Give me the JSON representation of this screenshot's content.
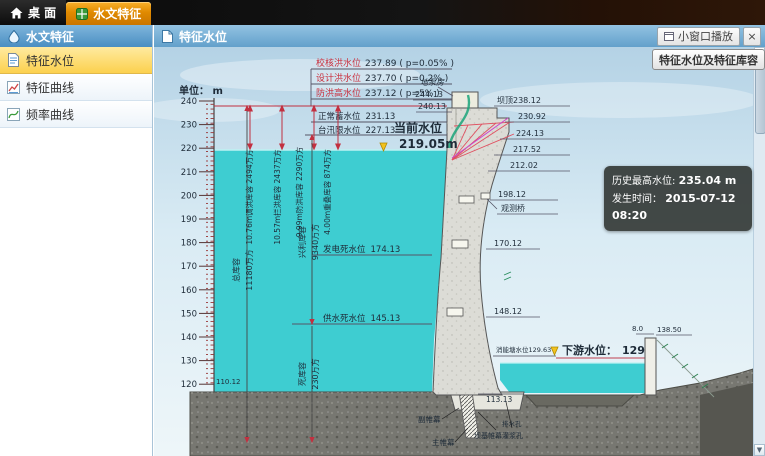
{
  "colors": {
    "accent_orange": "#e08a00",
    "header_blue": "#62a0cb",
    "water_teal": "#3ecdd1",
    "alert_red": "#e8312a",
    "selected_yellow": "#fcd14e"
  },
  "topbar": {
    "tabs": [
      {
        "label": "桌 面"
      },
      {
        "label": "水文特征"
      }
    ]
  },
  "sidebar": {
    "title": "水文特征",
    "items": [
      {
        "label": "特征水位"
      },
      {
        "label": "特征曲线"
      },
      {
        "label": "频率曲线"
      }
    ]
  },
  "panel": {
    "title": "特征水位",
    "small_window_label": "小窗口播放",
    "close_label": "×",
    "capacity_button_label": "特征水位及特征库容",
    "unit_label": "单位： m"
  },
  "info_box": {
    "history_label": "历史最高水位:",
    "history_value": "235.04 m",
    "time_label": "发生时间：",
    "time_value": "2015-07-12 08:20"
  },
  "current_level": {
    "label": "当前水位",
    "value": "219.05m"
  },
  "tail_level": {
    "label": "下游水位：",
    "value": "129m"
  },
  "diagram": {
    "ruler_ticks": [
      "240",
      "230",
      "220",
      "210",
      "200",
      "190",
      "180",
      "170",
      "160",
      "150",
      "140",
      "130",
      "120"
    ],
    "flood_levels": [
      {
        "name": "校核洪水位",
        "value": "237.89 ( p=0.05% )"
      },
      {
        "name": "设计洪水位",
        "value": "237.70 ( p=0.2% )"
      },
      {
        "name": "防洪高水位",
        "value": "237.12 ( p=5% )"
      }
    ],
    "levels": [
      {
        "name": "正常蓄水位",
        "value": "231.13"
      },
      {
        "name": "台汛限水位",
        "value": "227.13"
      },
      {
        "name": "发电死水位",
        "value": "174.13"
      },
      {
        "name": "供水死水位",
        "value": "145.13"
      }
    ],
    "capacity_arrows": [
      "10.76m调洪库容 2494万方",
      "10.57m拦洪库容 2437万方",
      "9.99m防洪库容 2290万方",
      "4.00m重叠库容 874万方"
    ],
    "storages": [
      {
        "name": "总库容",
        "value": "11180万方"
      },
      {
        "name": "兴利库容",
        "value": "9340万方"
      },
      {
        "name": "死库容",
        "value": "230万方"
      }
    ],
    "labels": {
      "pump_house": "地泵房",
      "pump_elev_top": "244.13",
      "pump_elev_mid": "240.13",
      "crest": "坝顶238.12",
      "elev_1": "230.92",
      "elev_2": "224.13",
      "elev_3": "217.52",
      "elev_4": "212.02",
      "obs_elev": "198.12",
      "obs_bridge": "观测桥",
      "face_elev_1": "170.12",
      "face_elev_2": "148.12",
      "stilling_level": "消能塘水位129.63",
      "wall_width": "8.0",
      "wall_elev": "138.50",
      "apron_elev": "113.13",
      "bed_elev": "110.12",
      "aux_curtain": "副帷幕",
      "main_curtain": "主帷幕",
      "drain_hole": "排水孔",
      "grout_curtain": "坝基帷幕灌浆孔"
    }
  }
}
